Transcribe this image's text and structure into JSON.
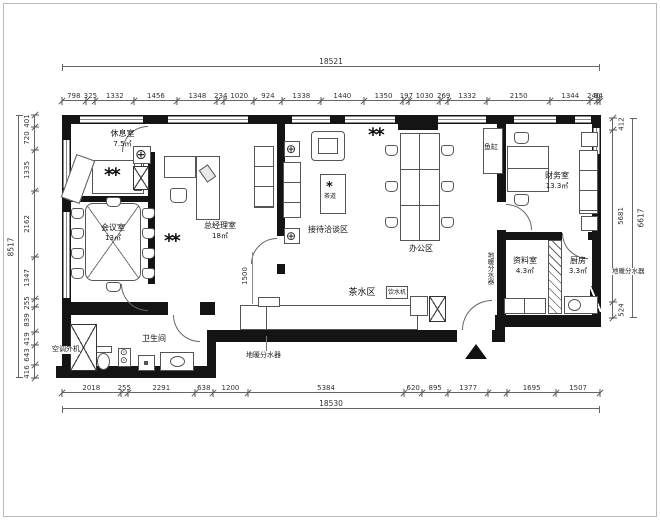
{
  "dimensions": {
    "top": {
      "total": "18521",
      "segments": [
        {
          "l": "798",
          "mm": 798
        },
        {
          "l": "325",
          "mm": 325
        },
        {
          "l": "1332",
          "mm": 1332
        },
        {
          "l": "1456",
          "mm": 1456
        },
        {
          "l": "1348",
          "mm": 1348
        },
        {
          "l": "234",
          "mm": 234
        },
        {
          "l": "1020",
          "mm": 1020
        },
        {
          "l": "924",
          "mm": 924
        },
        {
          "l": "1338",
          "mm": 1338
        },
        {
          "l": "1440",
          "mm": 1440
        },
        {
          "l": "1350",
          "mm": 1350
        },
        {
          "l": "197",
          "mm": 197
        },
        {
          "l": "1030",
          "mm": 1030
        },
        {
          "l": "269",
          "mm": 269
        },
        {
          "l": "1332",
          "mm": 1332
        },
        {
          "l": "2150",
          "mm": 2150
        },
        {
          "l": "1344",
          "mm": 1344
        },
        {
          "l": "240",
          "mm": 240
        },
        {
          "l": "94",
          "mm": 94
        }
      ]
    },
    "bottom": {
      "total": "18530",
      "segments": [
        {
          "l": "2018",
          "mm": 2018
        },
        {
          "l": "255",
          "mm": 255
        },
        {
          "l": "2291",
          "mm": 2291
        },
        {
          "l": "638",
          "mm": 638
        },
        {
          "l": "1200",
          "mm": 1200
        },
        {
          "l": "5384",
          "mm": 5384
        },
        {
          "l": "620",
          "mm": 620
        },
        {
          "l": "895",
          "mm": 895
        },
        {
          "l": "1377",
          "mm": 1377
        },
        {
          "l": "",
          "mm": 650
        },
        {
          "l": "1695",
          "mm": 1695
        },
        {
          "l": "1507",
          "mm": 1507
        }
      ]
    },
    "left": {
      "total": "8517",
      "segments": [
        {
          "l": "401",
          "mm": 401
        },
        {
          "l": "720",
          "mm": 720
        },
        {
          "l": "1335",
          "mm": 1335
        },
        {
          "l": "2162",
          "mm": 2162
        },
        {
          "l": "1347",
          "mm": 1347
        },
        {
          "l": "255",
          "mm": 255
        },
        {
          "l": "839",
          "mm": 839
        },
        {
          "l": "419",
          "mm": 419
        },
        {
          "l": "643",
          "mm": 643
        },
        {
          "l": "416",
          "mm": 416
        }
      ]
    },
    "right": {
      "total": "6617",
      "segments": [
        {
          "l": "412",
          "mm": 412
        },
        {
          "l": "5681",
          "mm": 5681
        },
        {
          "l": "524",
          "mm": 524
        }
      ]
    },
    "interior": {
      "corridor_width": "1500"
    }
  },
  "rooms": {
    "rest": {
      "name": "休息室",
      "area": "7.5㎡"
    },
    "meeting": {
      "name": "会议室",
      "area": "13㎡"
    },
    "manager": {
      "name": "总经理室",
      "area": "18㎡"
    },
    "reception": {
      "name": "接待洽谈区"
    },
    "office": {
      "name": "办公区"
    },
    "finance": {
      "name": "财务室",
      "area": "13.3㎡"
    },
    "archive": {
      "name": "资料室",
      "area": "4.3㎡"
    },
    "kitchen": {
      "name": "厨房",
      "area": "3.3㎡"
    },
    "tea": {
      "name": "茶水区"
    },
    "bathroom": {
      "name": "卫生间"
    }
  },
  "labels": {
    "fish_tank": "鱼缸",
    "ac_outdoor_unit": "空调外机",
    "water_dispenser": "饮水机",
    "floor_heating_manifold": "地暖分水器",
    "table_decor": "茶道"
  },
  "colors": {
    "wall": "#141414",
    "line": "#555555",
    "dim": "#666666"
  }
}
